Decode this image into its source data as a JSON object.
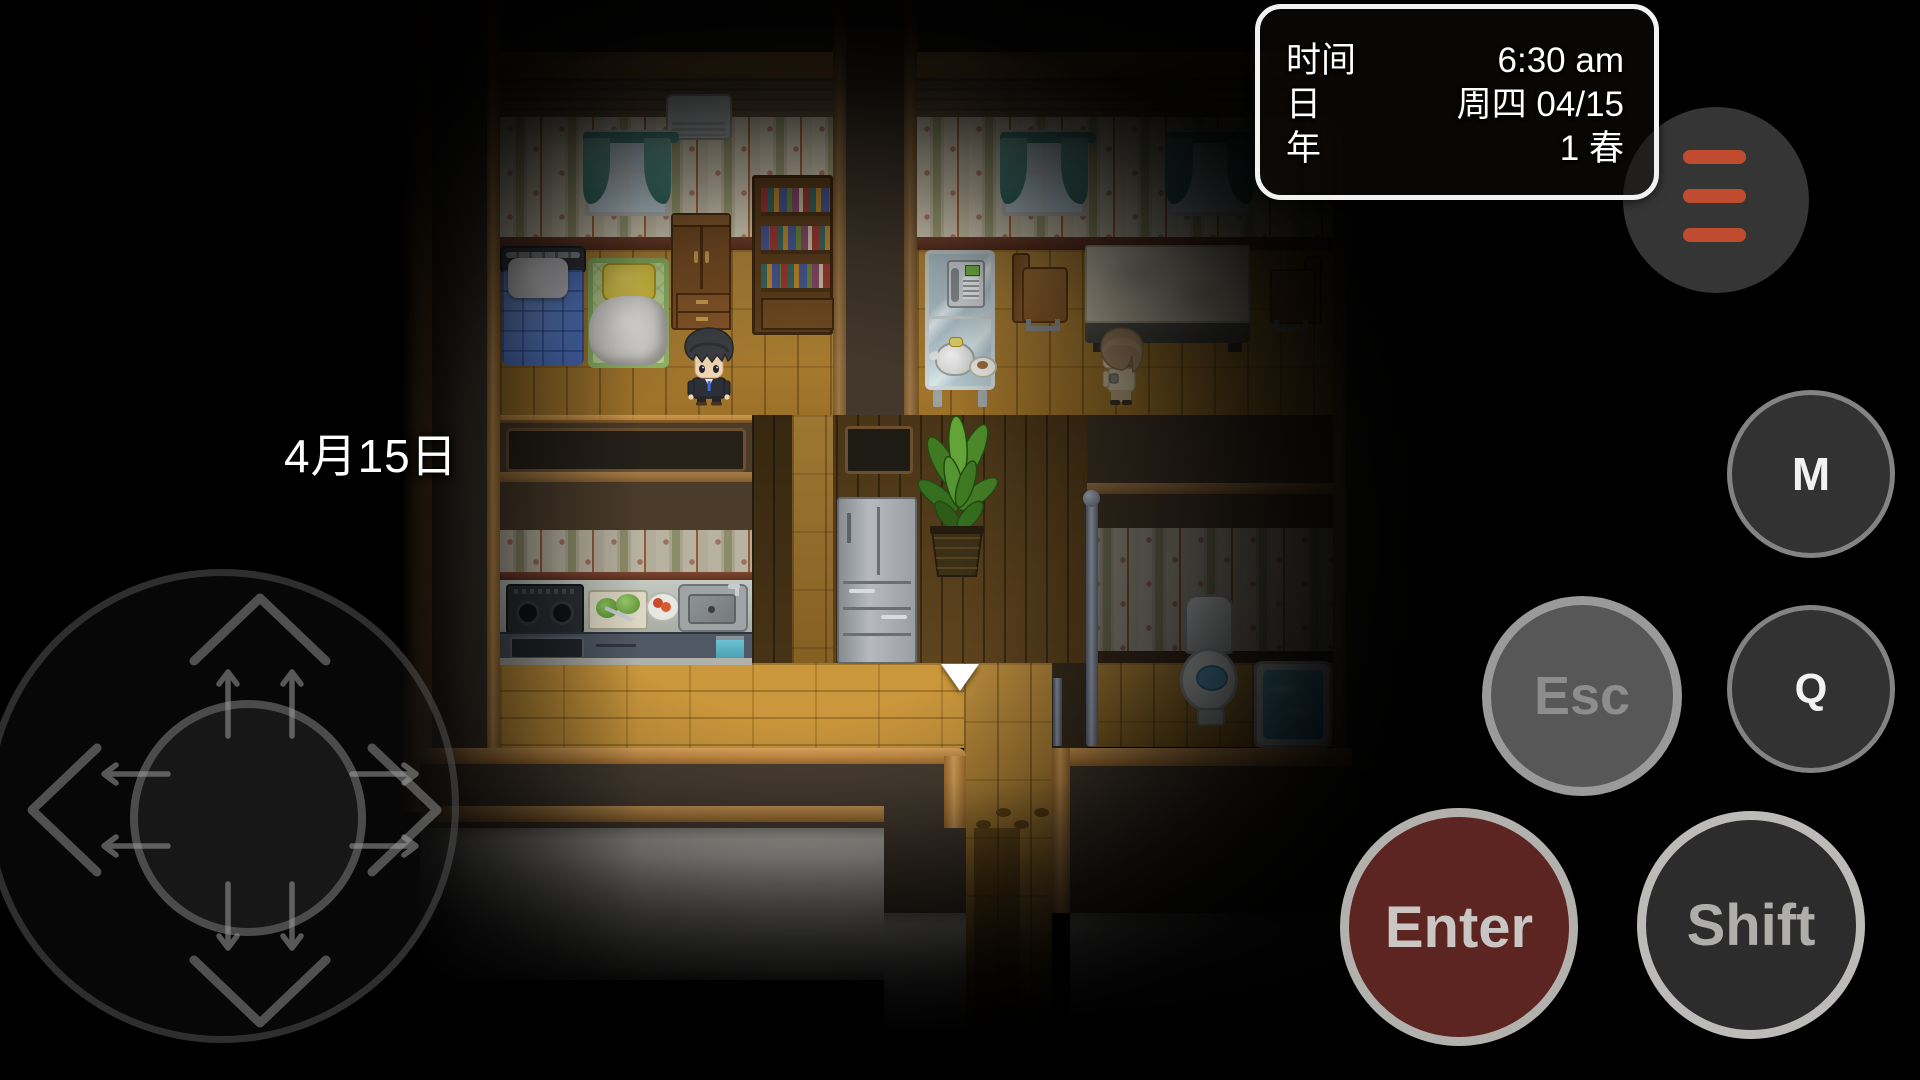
{
  "hud": {
    "clock": {
      "rows": [
        {
          "label": "时间",
          "value": "6:30 am"
        },
        {
          "label": "日",
          "value": "周四 04/15"
        },
        {
          "label": "年",
          "value": "1 春"
        }
      ]
    },
    "map_label": "4月15日",
    "menu_button": {
      "icon": "hamburger-icon",
      "bar_color": "#c14b2e"
    },
    "buttons": {
      "m": {
        "label": "M"
      },
      "q": {
        "label": "Q"
      },
      "esc": {
        "label": "Esc"
      },
      "enter": {
        "label": "Enter"
      },
      "shift": {
        "label": "Shift"
      }
    },
    "joystick": {
      "directions": [
        "up",
        "down",
        "left",
        "right"
      ]
    }
  },
  "scene": {
    "rooms": [
      "bedroom",
      "dining-room",
      "kitchen",
      "bathroom",
      "hallway"
    ],
    "characters": [
      {
        "id": "boy-black-hair",
        "location": "bedroom"
      },
      {
        "id": "resident-brown-hair",
        "location": "dining-room"
      }
    ],
    "cursor": "white-down-arrow"
  },
  "colors": {
    "background": "#000000",
    "menu_bars": "#c14b2e",
    "enter_button": "#6d2b28",
    "hud_border": "#f2f2f2",
    "wood_floor": "#c9953b",
    "wall_trim": "#d79c55"
  }
}
